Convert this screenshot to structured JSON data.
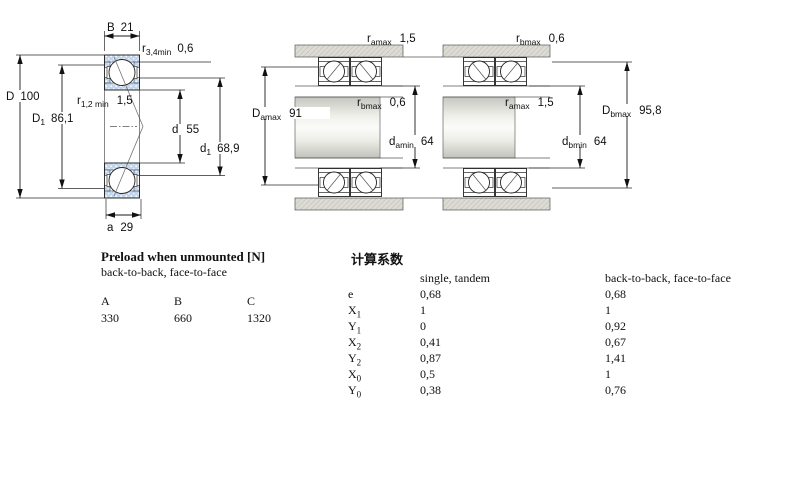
{
  "fig_bearing": {
    "B": {
      "t": "B",
      "v": "21"
    },
    "r34": {
      "t": "r",
      "s": "3,4min",
      "v": "0,6"
    },
    "D": {
      "t": "D",
      "v": "100"
    },
    "D1": {
      "t": "D",
      "s": "1",
      "v": "86,1"
    },
    "r12": {
      "t": "r",
      "s": "1,2 min",
      "v": "1,5"
    },
    "d": {
      "t": "d",
      "v": "55"
    },
    "d1": {
      "t": "d",
      "s": "1",
      "v": "68,9"
    },
    "a": {
      "t": "a",
      "v": "29"
    }
  },
  "fig_back_to_back": {
    "ramax": {
      "t": "r",
      "s": "amax",
      "v": "1,5"
    },
    "rbmax": {
      "t": "r",
      "s": "bmax",
      "v": "0,6"
    },
    "Damax": {
      "t": "D",
      "s": "amax",
      "v": "91"
    },
    "damin": {
      "t": "d",
      "s": "amin",
      "v": "64"
    }
  },
  "fig_face_to_face": {
    "rbmax": {
      "t": "r",
      "s": "bmax",
      "v": "0,6"
    },
    "ramax": {
      "t": "r",
      "s": "amax",
      "v": "1,5"
    },
    "Dbmax": {
      "t": "D",
      "s": "bmax",
      "v": "95,8"
    },
    "dbmin": {
      "t": "d",
      "s": "bmin",
      "v": "64"
    }
  },
  "preload_table": {
    "title": "Preload when unmounted [N]",
    "subtitle": "back-to-back, face-to-face",
    "columns": [
      "A",
      "B",
      "C"
    ],
    "values": [
      "330",
      "660",
      "1320"
    ]
  },
  "factors_table": {
    "title": "计算系数",
    "col1": "single, tandem",
    "col2": "back-to-back, face-to-face",
    "rows": [
      {
        "t": "e",
        "s": "",
        "single": "0,68",
        "paired": "0,68"
      },
      {
        "t": "X",
        "s": "1",
        "single": "1",
        "paired": "1"
      },
      {
        "t": "Y",
        "s": "1",
        "single": "0",
        "paired": "0,92"
      },
      {
        "t": "X",
        "s": "2",
        "single": "0,41",
        "paired": "0,67"
      },
      {
        "t": "Y",
        "s": "2",
        "single": "0,87",
        "paired": "1,41"
      },
      {
        "t": "X",
        "s": "0",
        "single": "0,5",
        "paired": "1"
      },
      {
        "t": "Y",
        "s": "0",
        "single": "0,38",
        "paired": "0,76"
      }
    ]
  }
}
